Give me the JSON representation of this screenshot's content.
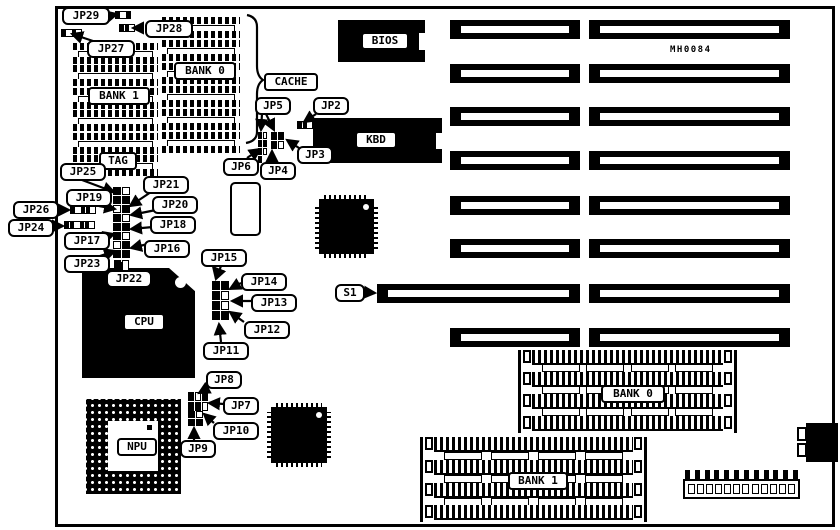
{
  "board": {
    "part_number": "MH0084"
  },
  "chips": {
    "bios": "BIOS",
    "kbd": "KBD",
    "cpu": "CPU",
    "npu": "NPU",
    "tag": "TAG",
    "cache": "CACHE"
  },
  "cache_banks": {
    "bank0": "BANK 0",
    "bank1": "BANK 1"
  },
  "simm_banks": {
    "bank0": "BANK 0",
    "bank1": "BANK 1"
  },
  "callouts": {
    "jp2": "JP2",
    "jp3": "JP3",
    "jp4": "JP4",
    "jp5": "JP5",
    "jp6": "JP6",
    "jp7": "JP7",
    "jp8": "JP8",
    "jp9": "JP9",
    "jp10": "JP10",
    "jp11": "JP11",
    "jp12": "JP12",
    "jp13": "JP13",
    "jp14": "JP14",
    "jp15": "JP15",
    "jp16": "JP16",
    "jp17": "JP17",
    "jp18": "JP18",
    "jp19": "JP19",
    "jp20": "JP20",
    "jp21": "JP21",
    "jp22": "JP22",
    "jp23": "JP23",
    "jp24": "JP24",
    "jp25": "JP25",
    "jp26": "JP26",
    "jp27": "JP27",
    "jp28": "JP28",
    "jp29": "JP29",
    "s1": "S1"
  }
}
